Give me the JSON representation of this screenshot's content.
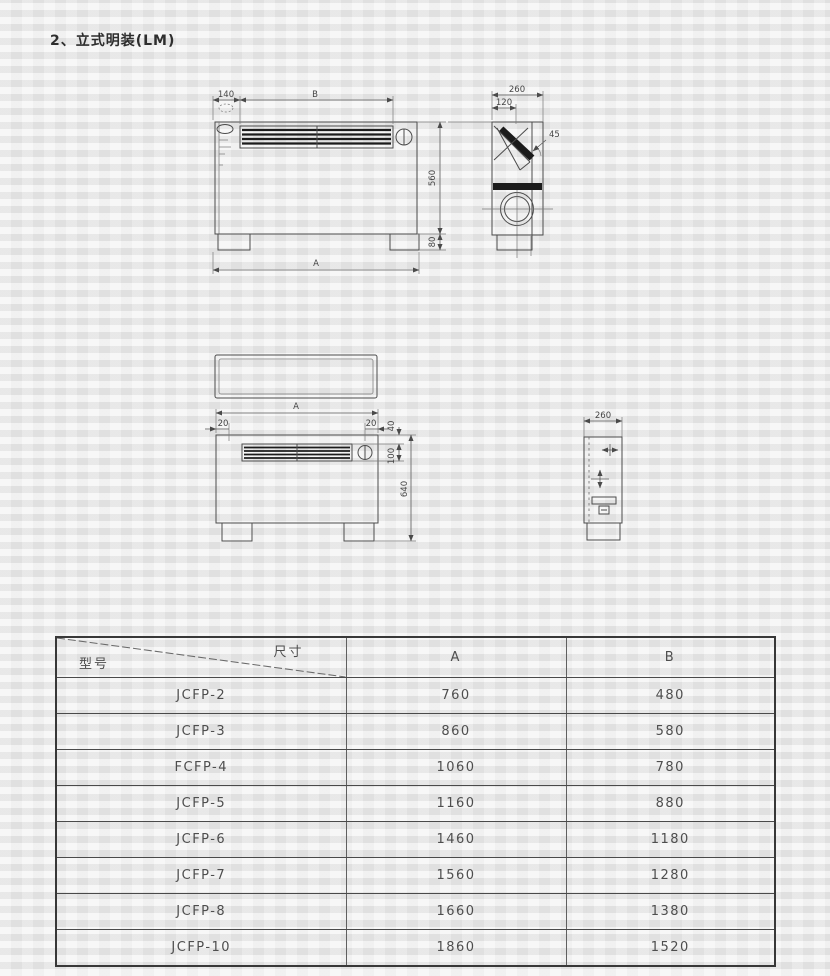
{
  "colors": {
    "paper": "#e9e9e9",
    "ink": "#3f3f3f"
  },
  "page": {
    "title": "2、立式明装(LM)"
  },
  "drawings": {
    "front_view": {
      "dim_left_offset": "140",
      "dim_grille_width": "B",
      "dim_body_height": "560",
      "dim_foot_height": "80",
      "dim_total_width": "A"
    },
    "side_view": {
      "dim_depth": "260",
      "dim_top_offset": "120",
      "dim_coil_angle": "45"
    },
    "front_view_2": {
      "dim_total_width": "A",
      "dim_left_overhang": "20",
      "dim_right_overhang": "20",
      "dim_top_gap": "40",
      "dim_grille_height": "100",
      "dim_total_height": "640"
    },
    "side_view_2": {
      "dim_depth": "260"
    }
  },
  "table": {
    "header": {
      "model_label": "型号",
      "size_label": "尺寸",
      "col_a": "A",
      "col_b": "B"
    },
    "rows": [
      {
        "model": "JCFP-2",
        "a": "760",
        "b": "480"
      },
      {
        "model": "JCFP-3",
        "a": "860",
        "b": "580"
      },
      {
        "model": "FCFP-4",
        "a": "1060",
        "b": "780"
      },
      {
        "model": "JCFP-5",
        "a": "1160",
        "b": "880"
      },
      {
        "model": "JCFP-6",
        "a": "1460",
        "b": "1180"
      },
      {
        "model": "JCFP-7",
        "a": "1560",
        "b": "1280"
      },
      {
        "model": "JCFP-8",
        "a": "1660",
        "b": "1380"
      },
      {
        "model": "JCFP-10",
        "a": "1860",
        "b": "1520"
      }
    ]
  }
}
